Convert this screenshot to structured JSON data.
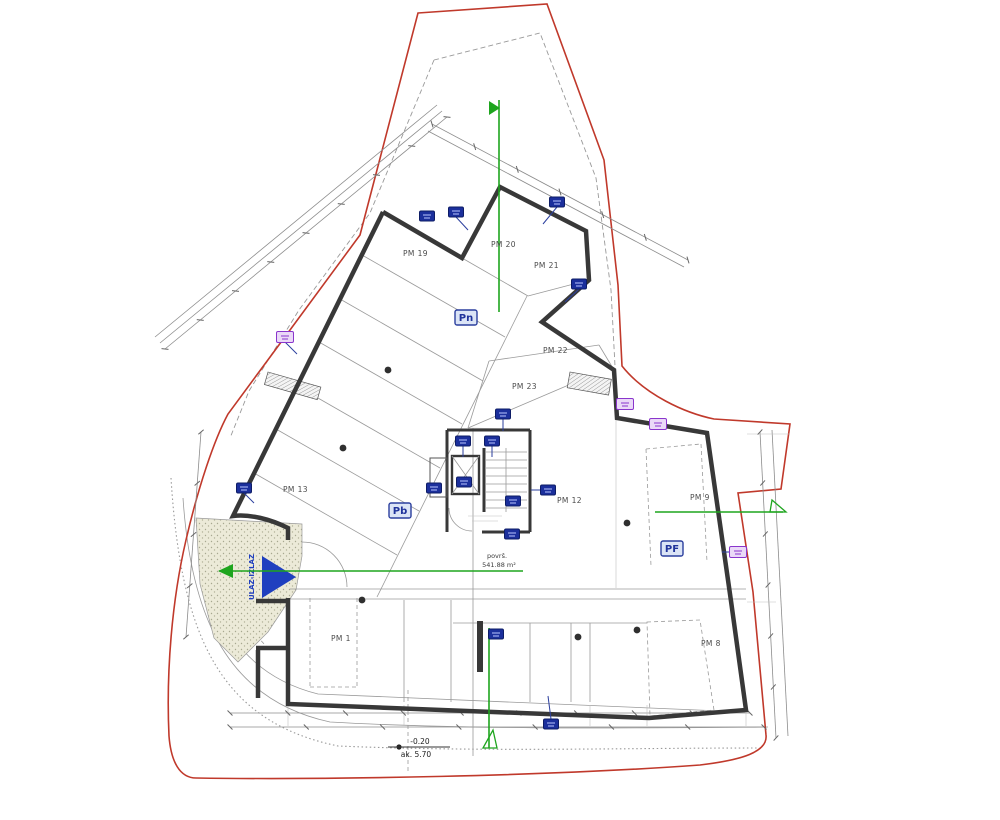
{
  "title": "garage floor plan drawing",
  "colors": {
    "boundary_red": "#c0392b",
    "wall_dark": "#383838",
    "section_green": "#1ea51e",
    "marker_blue": "#1b2f9c",
    "marker_purple": "#8a35cc",
    "zone_blue": "#20339b",
    "dim_gray": "#8c8c8c",
    "stipple_fill": "#ecead8"
  },
  "parking_labels": [
    {
      "label": "PM 19",
      "x": 403,
      "y": 256
    },
    {
      "label": "PM 20",
      "x": 491,
      "y": 247
    },
    {
      "label": "PM 21",
      "x": 534,
      "y": 268
    },
    {
      "label": "PM 22",
      "x": 543,
      "y": 353
    },
    {
      "label": "PM 23",
      "x": 512,
      "y": 389
    },
    {
      "label": "PM 13",
      "x": 283,
      "y": 492
    },
    {
      "label": "PM 12",
      "x": 557,
      "y": 503
    },
    {
      "label": "PM 9",
      "x": 690,
      "y": 500
    },
    {
      "label": "PM 8",
      "x": 701,
      "y": 646
    },
    {
      "label": "PM 1",
      "x": 331,
      "y": 641
    }
  ],
  "zone_labels": {
    "pn": "Pn",
    "pb": "Pb",
    "pf": "PF"
  },
  "ramp": {
    "arrow_text": "ULAZ-IZLAZ"
  },
  "area_note": {
    "line1": "površ.",
    "line2": "541.88 m²"
  },
  "elevation_marker": {
    "top": "-0.20",
    "bottom": "ak. 5.70"
  },
  "wall_markers": [
    {
      "x": 427,
      "y": 216,
      "color": "blue"
    },
    {
      "x": 456,
      "y": 212,
      "color": "blue"
    },
    {
      "x": 557,
      "y": 202,
      "color": "blue"
    },
    {
      "x": 579,
      "y": 284,
      "color": "blue"
    },
    {
      "x": 503,
      "y": 414,
      "color": "blue"
    },
    {
      "x": 463,
      "y": 441,
      "color": "blue"
    },
    {
      "x": 492,
      "y": 441,
      "color": "blue"
    },
    {
      "x": 434,
      "y": 488,
      "color": "blue"
    },
    {
      "x": 464,
      "y": 482,
      "color": "blue"
    },
    {
      "x": 548,
      "y": 490,
      "color": "blue"
    },
    {
      "x": 513,
      "y": 501,
      "color": "blue"
    },
    {
      "x": 512,
      "y": 534,
      "color": "blue"
    },
    {
      "x": 244,
      "y": 488,
      "color": "blue"
    },
    {
      "x": 496,
      "y": 634,
      "color": "blue"
    },
    {
      "x": 551,
      "y": 724,
      "color": "blue"
    },
    {
      "x": 285,
      "y": 337,
      "color": "purple"
    },
    {
      "x": 625,
      "y": 404,
      "color": "purple"
    },
    {
      "x": 658,
      "y": 424,
      "color": "purple"
    },
    {
      "x": 738,
      "y": 552,
      "color": "purple"
    }
  ],
  "columns": [
    {
      "x": 388,
      "y": 370
    },
    {
      "x": 343,
      "y": 448
    },
    {
      "x": 362,
      "y": 600
    },
    {
      "x": 578,
      "y": 637
    },
    {
      "x": 637,
      "y": 630
    },
    {
      "x": 627,
      "y": 523
    }
  ]
}
